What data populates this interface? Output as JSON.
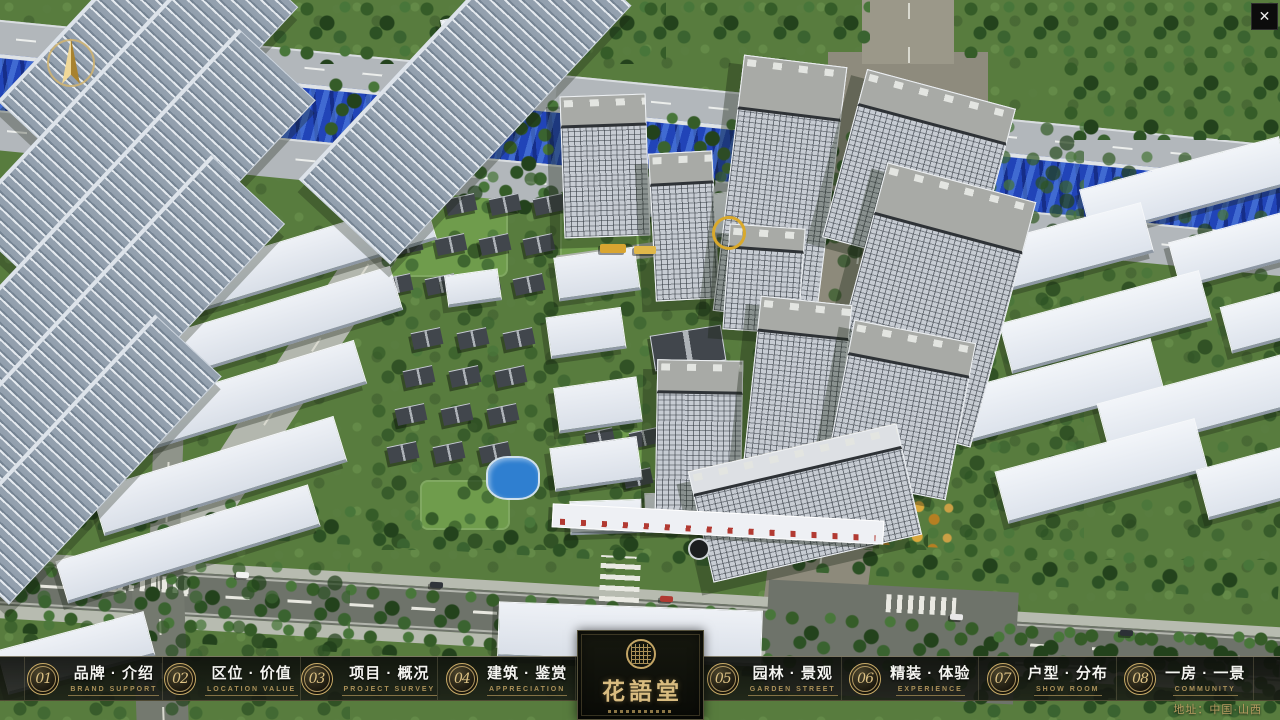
{
  "app": {
    "close_glyph": "✕",
    "address": "地址：中国·山西"
  },
  "logo": {
    "title": "花語堂"
  },
  "menu": {
    "items": [
      {
        "num": "01",
        "label": "品牌 · 介绍",
        "sublabel": "BRAND SUPPORT"
      },
      {
        "num": "02",
        "label": "区位 · 价值",
        "sublabel": "LOCATION VALUE"
      },
      {
        "num": "03",
        "label": "项目 · 概况",
        "sublabel": "PROJECT SURVEY"
      },
      {
        "num": "04",
        "label": "建筑 · 鉴赏",
        "sublabel": "APPRECIATION"
      },
      {
        "num": "05",
        "label": "园林 · 景观",
        "sublabel": "GARDEN STREET"
      },
      {
        "num": "06",
        "label": "精装 · 体验",
        "sublabel": "EXPERIENCE"
      },
      {
        "num": "07",
        "label": "户型 · 分布",
        "sublabel": "SHOW ROOM"
      },
      {
        "num": "08",
        "label": "一房 · 一景",
        "sublabel": "COMMUNITY"
      }
    ]
  },
  "colors": {
    "gold": "#c9ab67",
    "bar_bg": "#111310",
    "river": "#2144b8"
  }
}
